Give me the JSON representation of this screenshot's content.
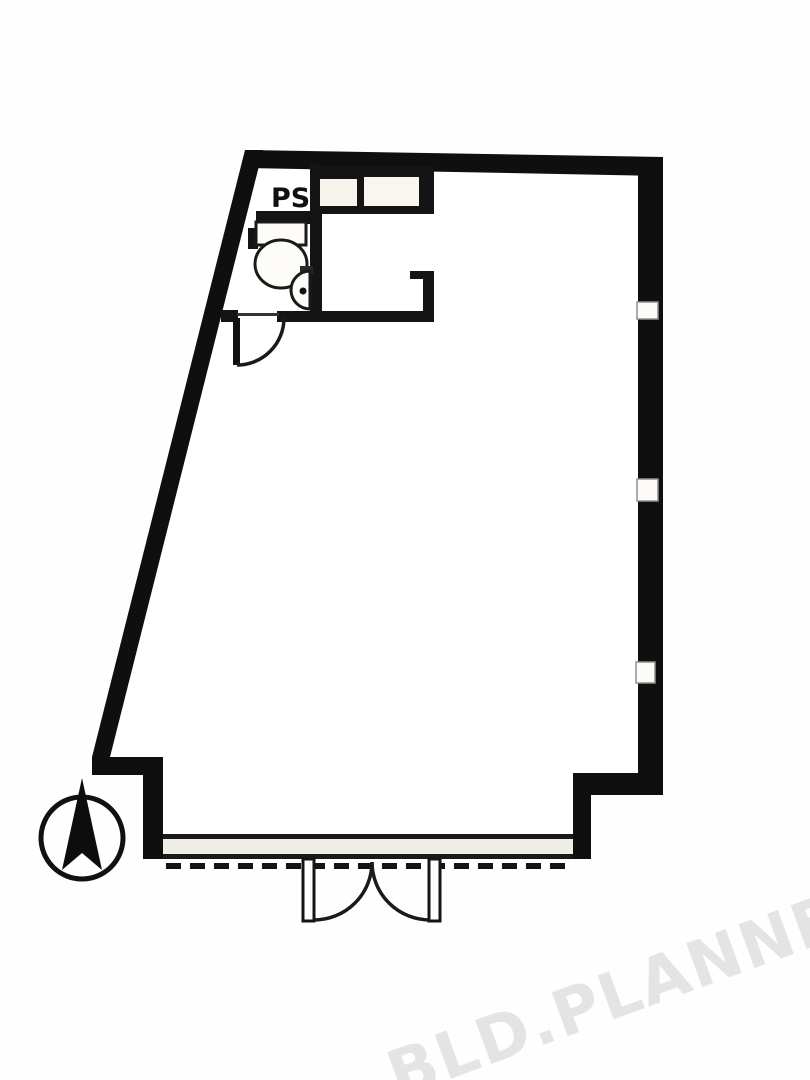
{
  "document": {
    "type": "architectural-floor-plan",
    "orientation_marker": "north-arrow-compass"
  },
  "labels": {
    "ps": "PS"
  },
  "watermark": {
    "text": "BLD.PLANNER",
    "color": "#e4e4e4"
  },
  "colors": {
    "wall": "#0f0f0f",
    "partition": "#141414",
    "paper": "#fefefe",
    "interior": "#ffffff",
    "storefront_band": "#f0eee4",
    "window_fill": "#fcfbf7",
    "window_border": "#8f8f8f"
  },
  "features": {
    "windows_on_right_wall": 3,
    "entrance": "double-swing-door",
    "wc_fixtures": [
      "toilet",
      "hand-basin"
    ],
    "service_shaft": "PS",
    "kitchen_counter_units": 2
  }
}
